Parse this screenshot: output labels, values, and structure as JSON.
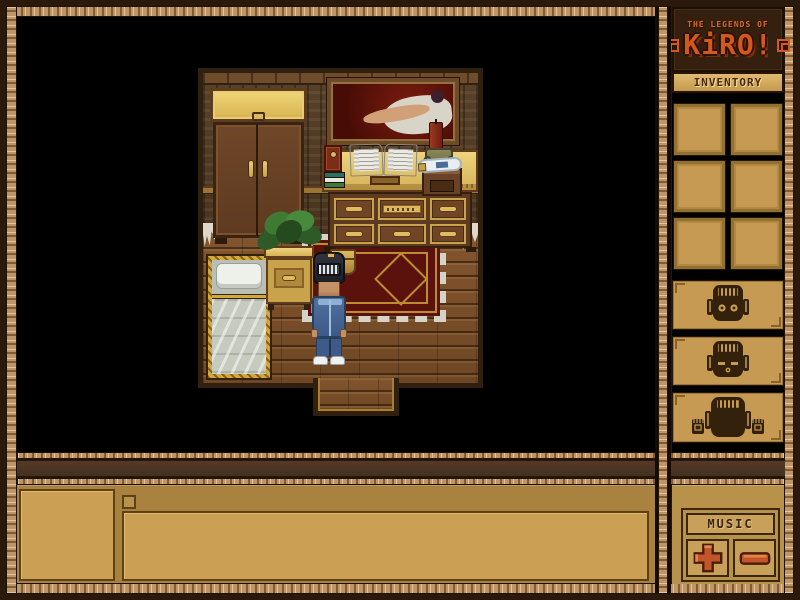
{
  "logo": {
    "title_top": "THE LEGENDS OF",
    "title_main": "KiRO!"
  },
  "sidebar": {
    "inventory_label": "INVENTORY",
    "inventory_slot_count": 6,
    "mask_buttons": [
      {
        "name": "mask-eyes-open"
      },
      {
        "name": "mask-eyes-closed-mouth"
      },
      {
        "name": "mask-with-hands"
      }
    ],
    "music": {
      "label": "MUSIC",
      "volume_up_icon": "plus",
      "volume_down_icon": "minus"
    }
  },
  "scene": {
    "room_objects": [
      "wardrobe",
      "painting-reclining-figure",
      "desk-dresser",
      "red-book",
      "book-stack",
      "open-book",
      "candle",
      "urn",
      "bottle",
      "small-chest",
      "potted-plant",
      "nightstand",
      "bed",
      "rug",
      "doorway"
    ],
    "player": {
      "outfit": "blue-tracksuit",
      "headgear": "grill-helmet",
      "shoes": "white-sneakers"
    }
  },
  "bottom_panel": {
    "portrait_box": "",
    "message_box": "",
    "status_bar": ""
  },
  "colors": {
    "logo_orange": "#d4581c",
    "panel_tan": "#c69a52",
    "frame_rope": "#c09565",
    "outer_border": "#2b1a0c",
    "button_red": "#c2552a",
    "rug_red": "#5c120c",
    "viewport_bg": "#000000"
  }
}
